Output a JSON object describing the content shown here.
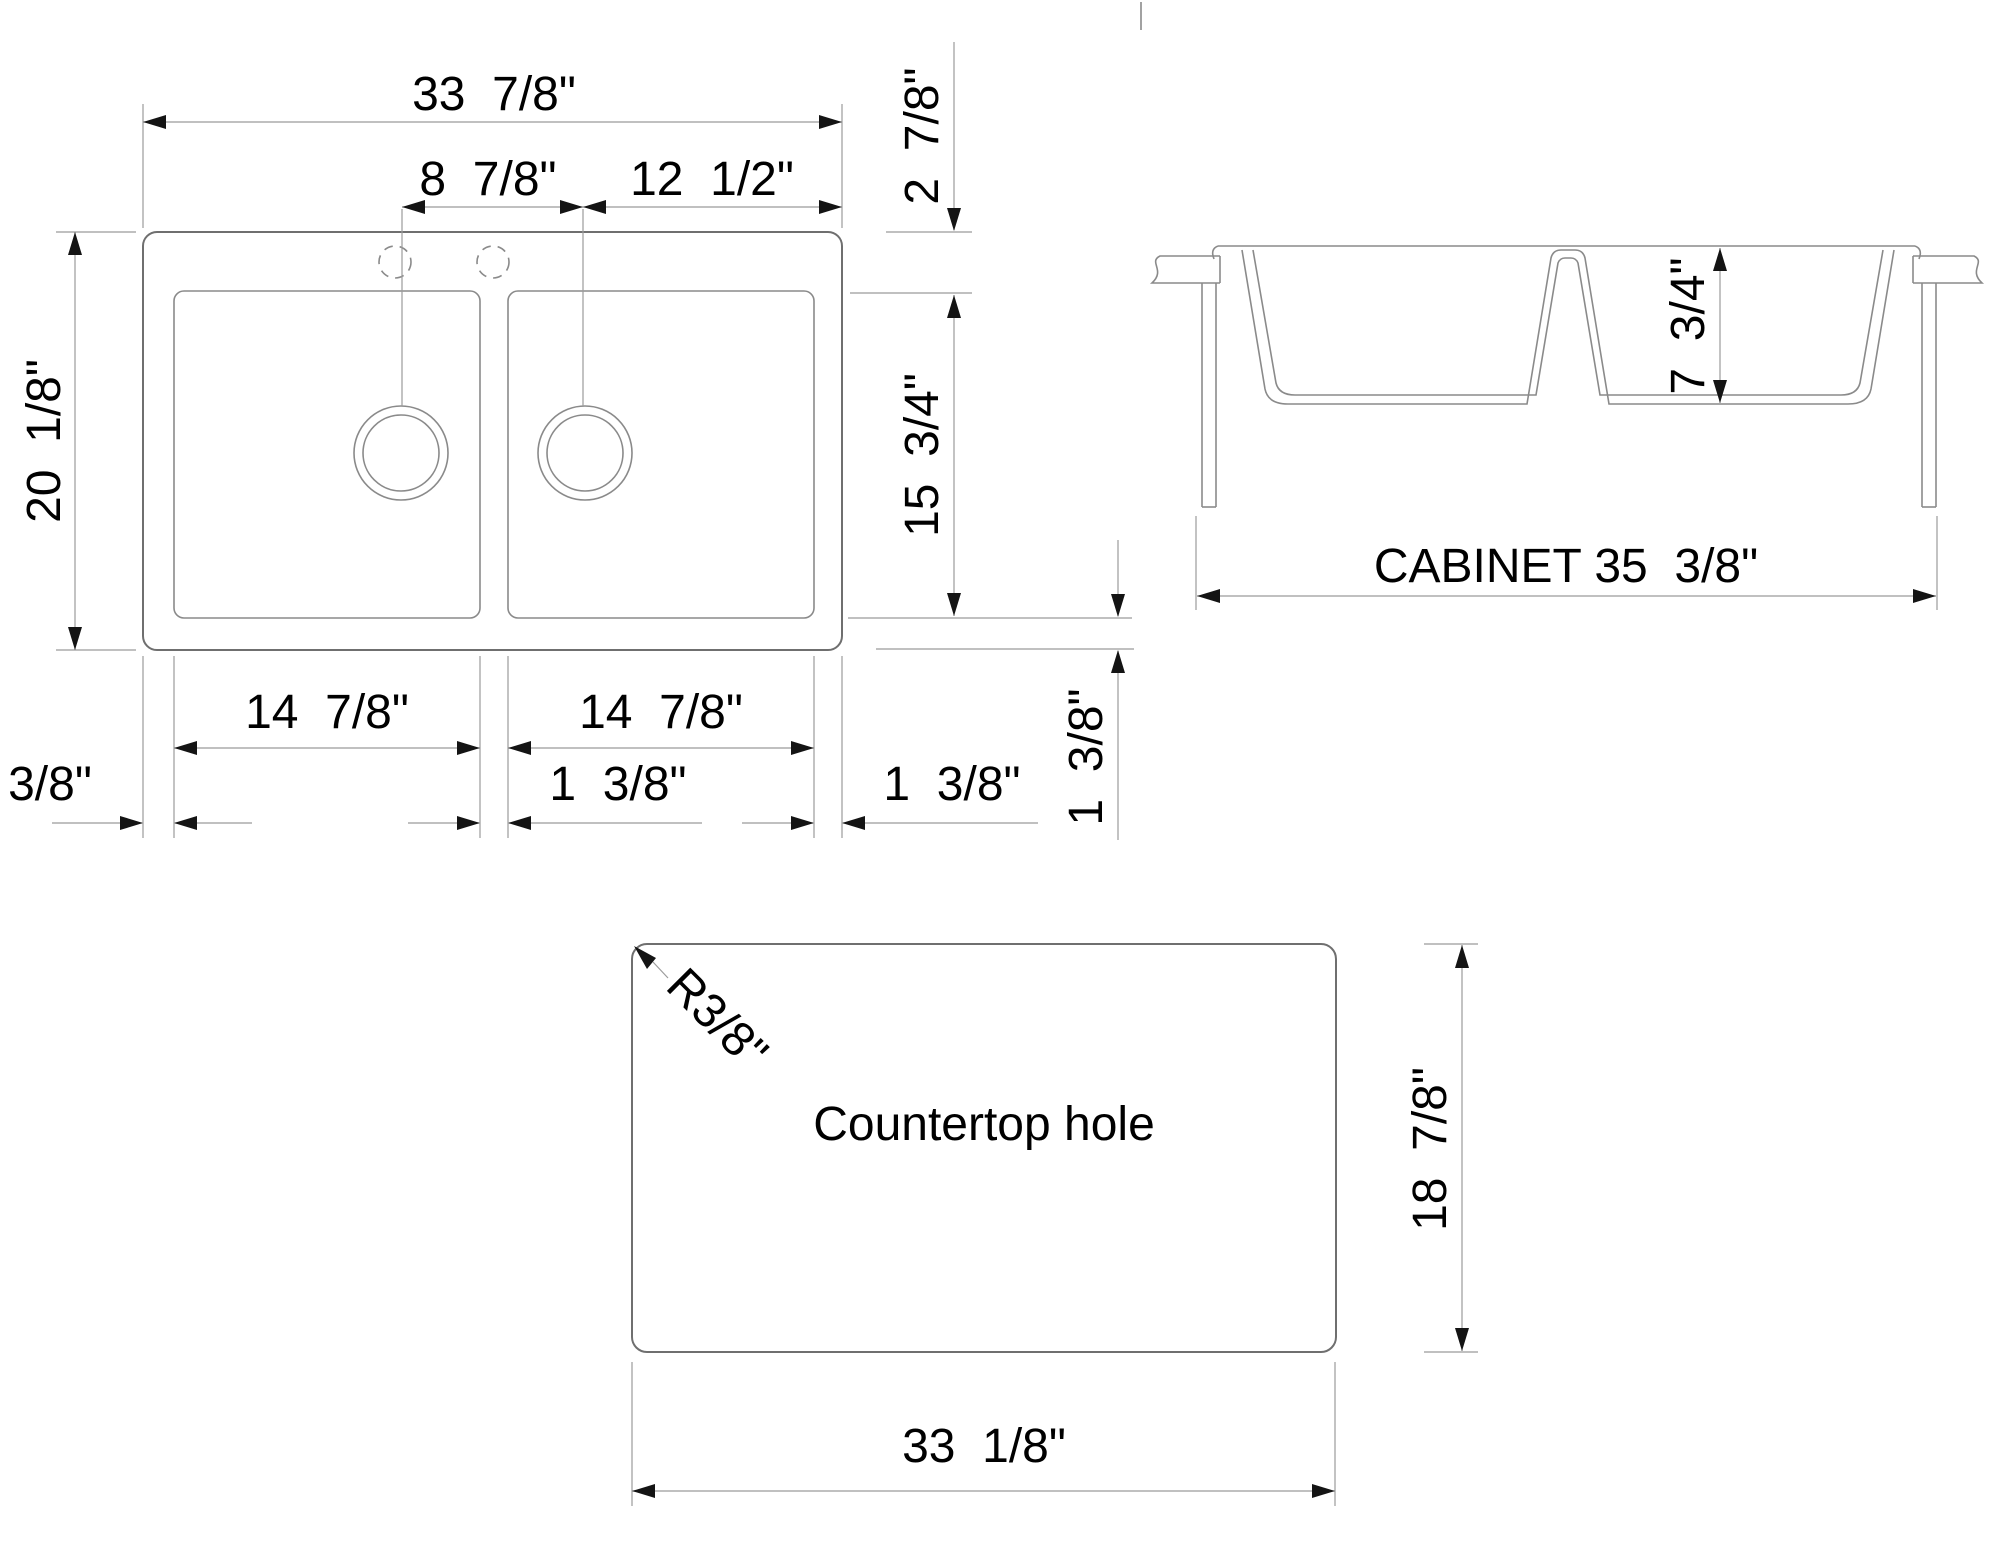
{
  "drawing": {
    "plan_view": {
      "width_overall": "33  7/8\"",
      "faucet_to_drain": "8  7/8\"",
      "drain_to_edge": "12  1/2\"",
      "depth_overall": "20  1/8\"",
      "top_rim": "2  7/8\"",
      "bowl_front_to_back": "15  3/4\"",
      "bowl_left_width": "14  7/8\"",
      "bowl_right_width": "14  7/8\"",
      "left_rim": "3/8\"",
      "divider_width": "1  3/8\"",
      "right_rim": "1  3/8\"",
      "bottom_rim": "1  3/8\""
    },
    "front_view": {
      "bowl_depth": "7  3/4\"",
      "cabinet_width": "CABINET 35  3/8\""
    },
    "countertop_view": {
      "label": "Countertop hole",
      "corner_radius": "R3/8\"",
      "hole_height": "18  7/8\"",
      "hole_width": "33  1/8\""
    },
    "colors": {
      "object_line": "#6f6f6f",
      "dimension_line": "#9b9b9b",
      "text": "#000000",
      "background": "#ffffff"
    }
  }
}
